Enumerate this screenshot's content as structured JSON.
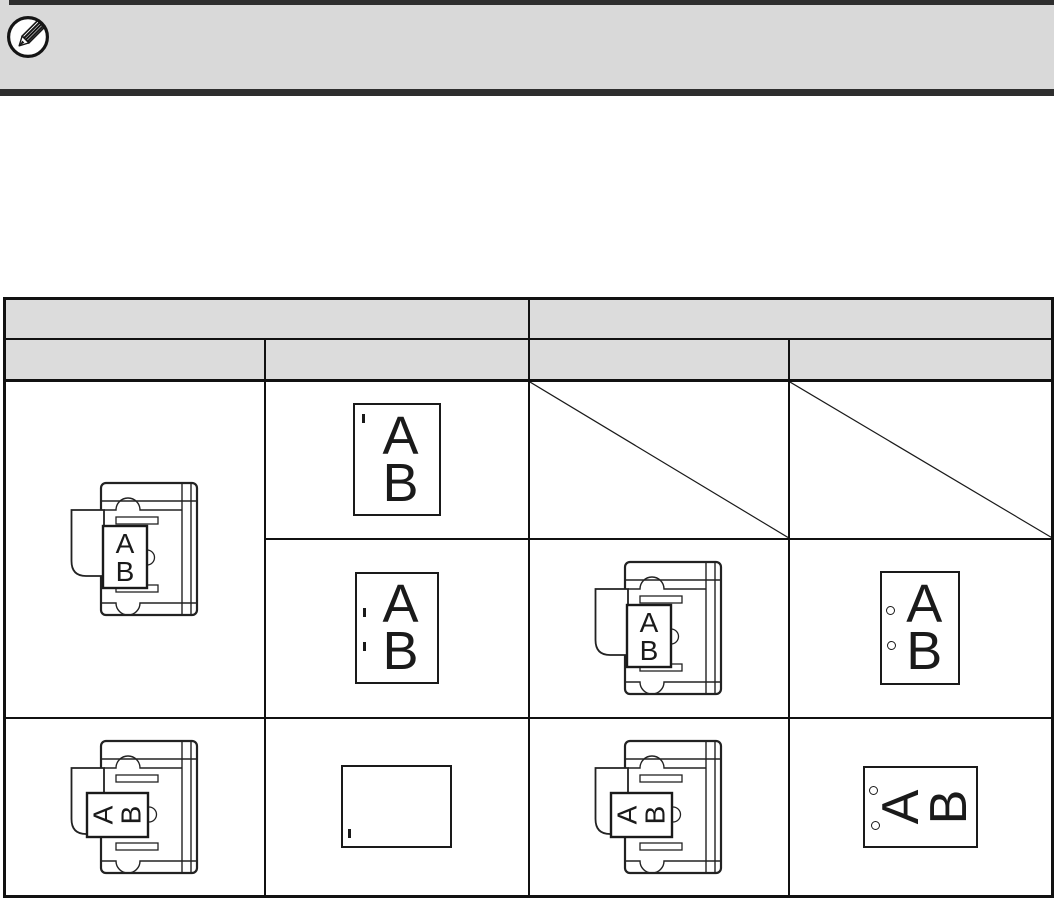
{
  "note": {
    "icon": "pencil-note-icon",
    "text": "",
    "bg_color": "#d9d9d9",
    "bar_color": "#2e2e2e"
  },
  "letters": {
    "a": "A",
    "b": "B"
  },
  "table": {
    "header": {
      "group_left": "",
      "group_right": "",
      "col1": "",
      "col2": "",
      "col3": "",
      "col4": ""
    },
    "header_bg": "#dcdcdc",
    "border_color": "#111111",
    "cells": [
      {
        "row": 1,
        "col": 1,
        "content": "adf-original-portrait",
        "letters": "A/B upright"
      },
      {
        "row": 1,
        "col": 2,
        "sub": "top",
        "content": "output-portrait",
        "marks": "one staple, top-left corner"
      },
      {
        "row": 1,
        "col": 3,
        "sub": "top",
        "content": "not-available-diagonal"
      },
      {
        "row": 1,
        "col": 4,
        "sub": "top",
        "content": "not-available-diagonal"
      },
      {
        "row": 1,
        "col": 2,
        "sub": "bottom",
        "content": "output-portrait",
        "marks": "two staples, left edge"
      },
      {
        "row": 1,
        "col": 3,
        "sub": "bottom",
        "content": "adf-original-portrait",
        "letters": "A/B upright"
      },
      {
        "row": 1,
        "col": 4,
        "sub": "bottom",
        "content": "output-portrait",
        "marks": "two punch holes, left edge"
      },
      {
        "row": 2,
        "col": 1,
        "content": "adf-original-rotated",
        "letters": "A/B rotated 90"
      },
      {
        "row": 2,
        "col": 2,
        "content": "output-landscape-blank",
        "marks": "one staple, bottom-left corner"
      },
      {
        "row": 2,
        "col": 3,
        "content": "adf-original-rotated",
        "letters": "A/B rotated 90"
      },
      {
        "row": 2,
        "col": 4,
        "content": "output-rotated",
        "marks": "two punch holes, left edge",
        "letters": "A/B rotated 90"
      }
    ]
  }
}
